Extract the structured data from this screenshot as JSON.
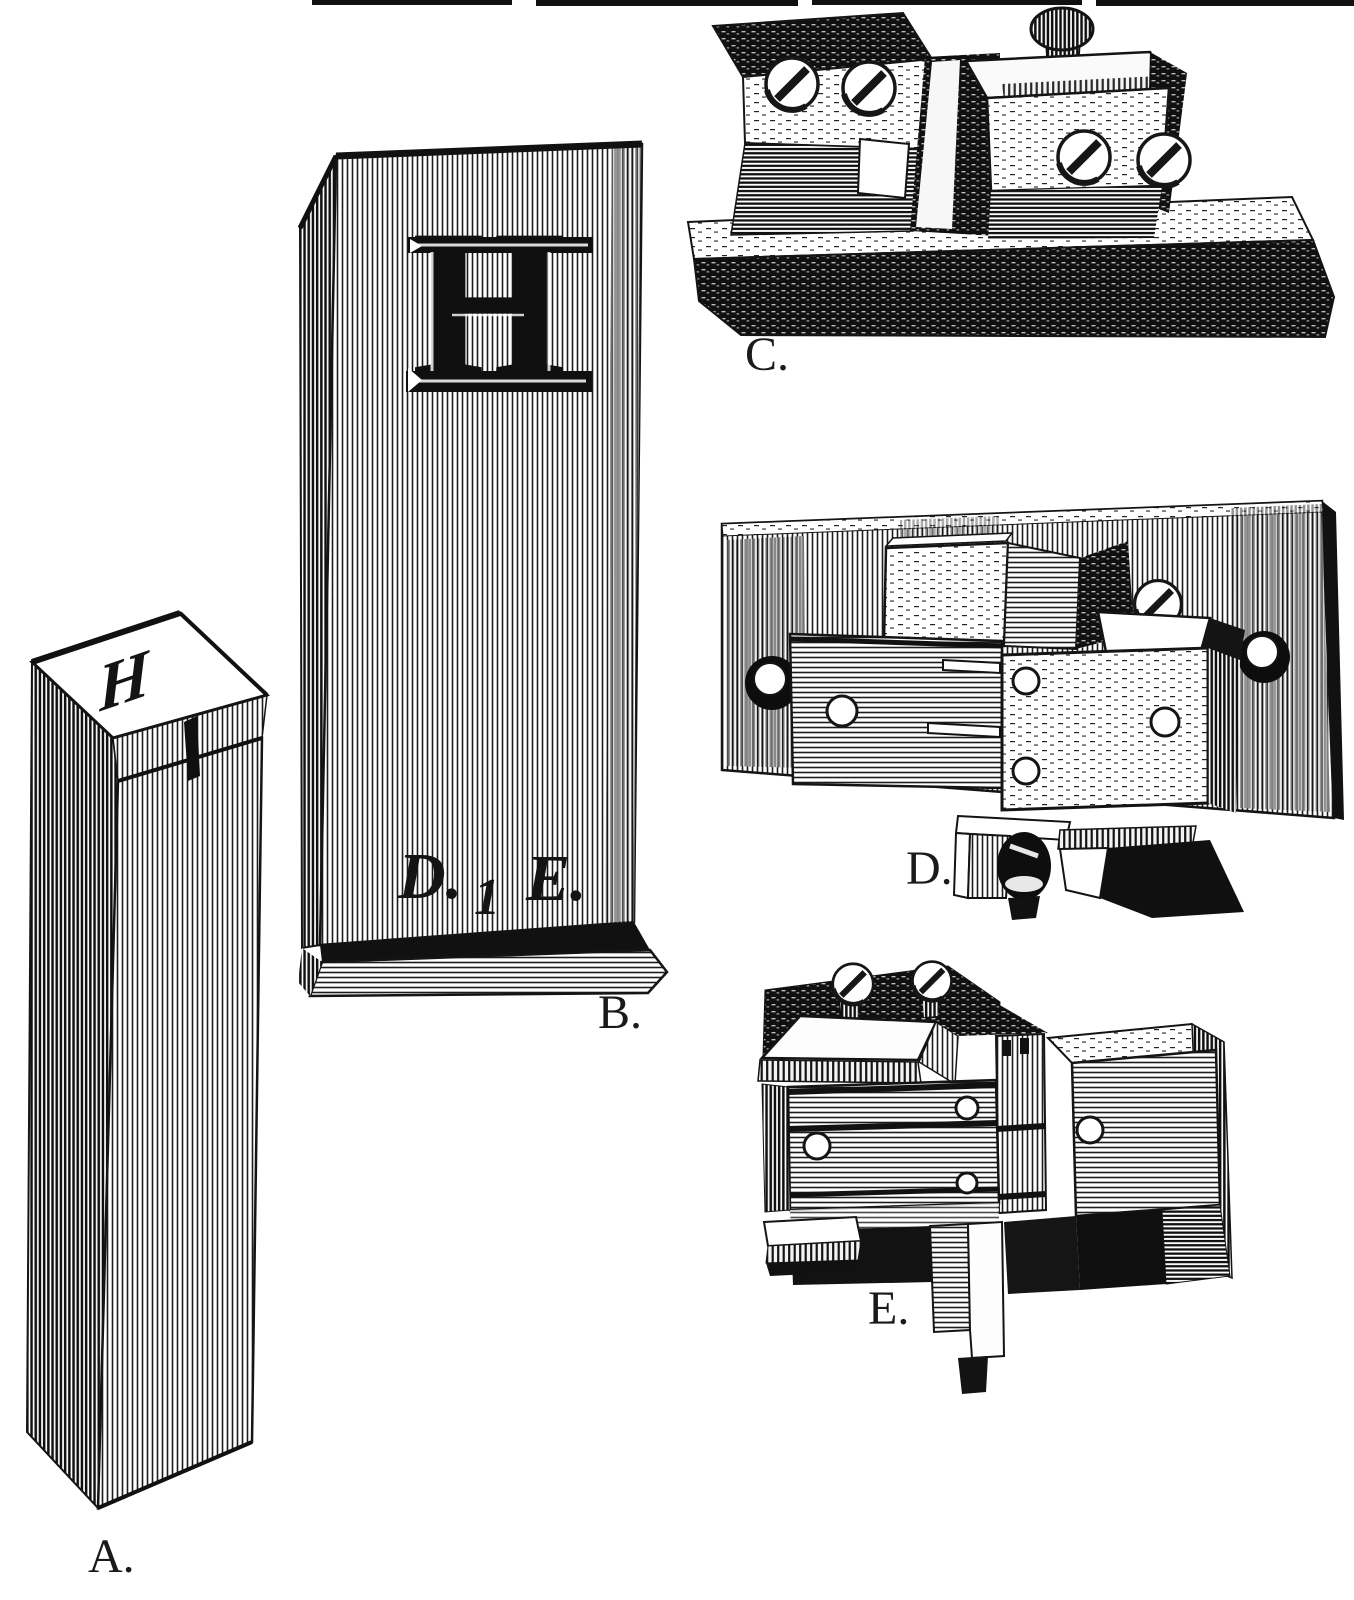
{
  "figure_labels": {
    "a": "A.",
    "b": "B.",
    "c": "C.",
    "d": "D.",
    "e": "E."
  },
  "letters": {
    "block_b_face": "H",
    "type_a_face": "H",
    "matrix_c": "H"
  },
  "founders_mark": {
    "left": "D.",
    "numeral": "1",
    "right": "E."
  },
  "colors": {
    "ink": "#161616",
    "paper": "#ffffff"
  }
}
